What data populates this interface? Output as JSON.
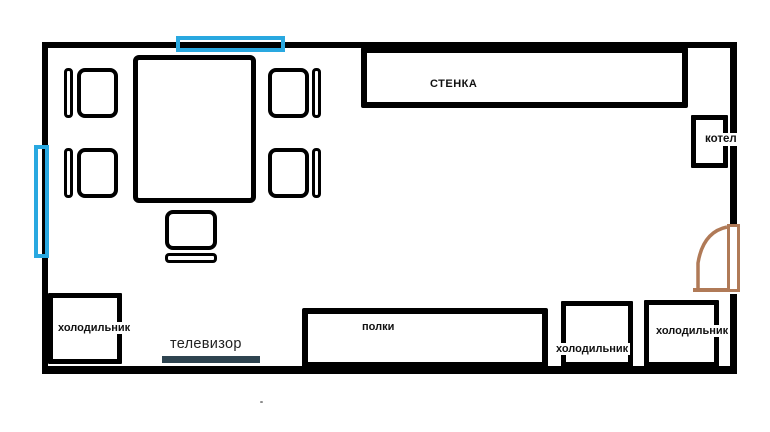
{
  "floor_plan": {
    "title": "room-furniture-floor-plan",
    "labels": {
      "wall_unit": "СТЕНКА",
      "boiler": "котел",
      "fridge_left": "холодильник",
      "shelves": "полки",
      "tv": "телевизор",
      "fridge_bottom_middle": "холодильник",
      "fridge_bottom_right": "холодильник"
    },
    "colors": {
      "wall": "#000000",
      "window": "#29A8E0",
      "door": "#B07A57",
      "tv_bar": "#2E4450"
    }
  }
}
